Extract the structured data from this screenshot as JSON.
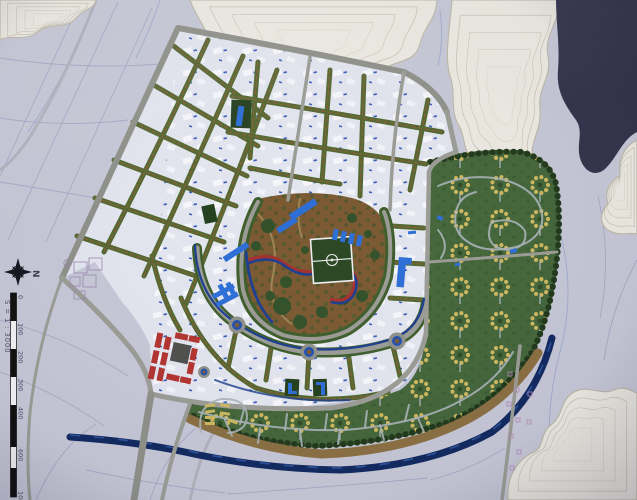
{
  "photo": {
    "title": "Aerial photograph of an urban master-plan scale model",
    "description": "Physical architectural maquette: white residential blocks with tree-lined streets, central park with sports field and canal, green villa compounds along a river, red terraced cluster, layered contour hills and a dark lake on a printed base map.",
    "scale": "1 : 3000"
  },
  "compass": {
    "label": "N"
  },
  "scale_bar": {
    "caption": "S = 1 : 3000",
    "ticks": [
      "0",
      "100",
      "200",
      "300",
      "400",
      "600",
      "1000"
    ]
  },
  "palette": {
    "base_map": "#c6c7d6",
    "map_line": "#a09ac0",
    "terrain": "#ebe9e1",
    "contour_line": "#c2bcab",
    "lake": "#34344c",
    "road": "#9c9c96",
    "city_block": "#e2e4ee",
    "street_green": "#51682f",
    "street_median": "#7c5f38",
    "park_ground": "#7b5a33",
    "park_tree": "#33512a",
    "sports_field": "#2b4723",
    "field_line": "#eceff2",
    "canal_blue": "#1d3f90",
    "river": "#122a60",
    "shore": "#8a6f42",
    "villa_green": "#45673b",
    "villa_tan": "#cdb75f",
    "villa_lane": "#aab2b8",
    "accent_blue": "#2e6fd6",
    "accent_red": "#b23430",
    "building_gray": "#4f4f4d",
    "outline_pink": "#b08ab8",
    "path_red": "#a23230",
    "mini_park": "#24401e"
  },
  "features": {
    "terrain": "contour hills",
    "lake": "lake",
    "city": "residential blocks",
    "park": "central park",
    "field": "soccer field",
    "villas": "villa compounds",
    "river": "river",
    "red_block": "red terraced housing"
  }
}
